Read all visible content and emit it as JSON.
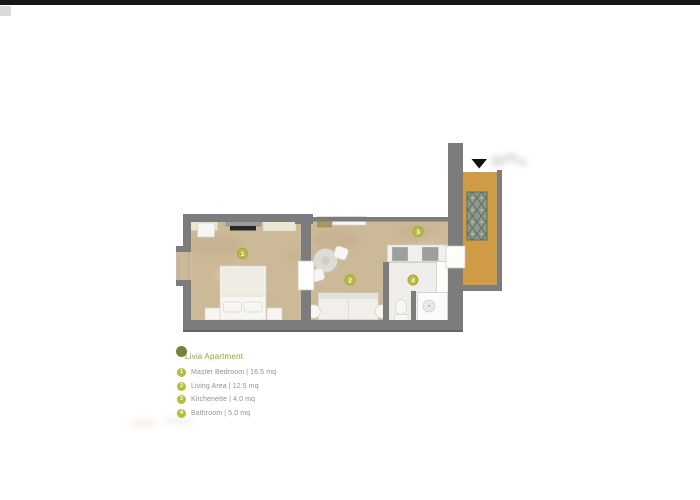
{
  "legend": {
    "title": "Livia Apartment",
    "items": [
      {
        "num": "1",
        "label": "Master Bedroom | 16.5 mq"
      },
      {
        "num": "2",
        "label": "Living Area | 12.5 mq"
      },
      {
        "num": "3",
        "label": "Kitchenette | 4.0 mq"
      },
      {
        "num": "4",
        "label": "Bathroom | 5.0 mq"
      }
    ]
  },
  "plan": {
    "room_markers": [
      {
        "num": "1",
        "room": "master-bedroom"
      },
      {
        "num": "2",
        "room": "living-area"
      },
      {
        "num": "3",
        "room": "kitchenette"
      },
      {
        "num": "4",
        "room": "bathroom"
      }
    ],
    "icons": {
      "entrance_arrow": "▼",
      "apartment_marker": "●"
    },
    "colors": {
      "top_bar": "#161616",
      "wall": "#7c7c7c",
      "wall_dark": "#646464",
      "floor": "#ccb998",
      "floor_shade": "#b59f79",
      "floor_light": "#e4d7ba",
      "bath_floor": "#efeeea",
      "corridor": "#cf9c45",
      "rug_base": "#8d988a",
      "rug_diamond": "#5e6e60",
      "furniture_cream": "#e9e8d3",
      "furniture_white": "#f7f6f2",
      "counter_gray": "#9aa0a0",
      "console_gray": "#9c9c9c",
      "tv_dark": "#262626",
      "olive_item": "#a89a5e",
      "marker": "#b8bc3e",
      "marker_dark": "#7c8038",
      "title_text": "#95a23c",
      "legend_text": "#929292",
      "arrow": "#111111"
    }
  }
}
